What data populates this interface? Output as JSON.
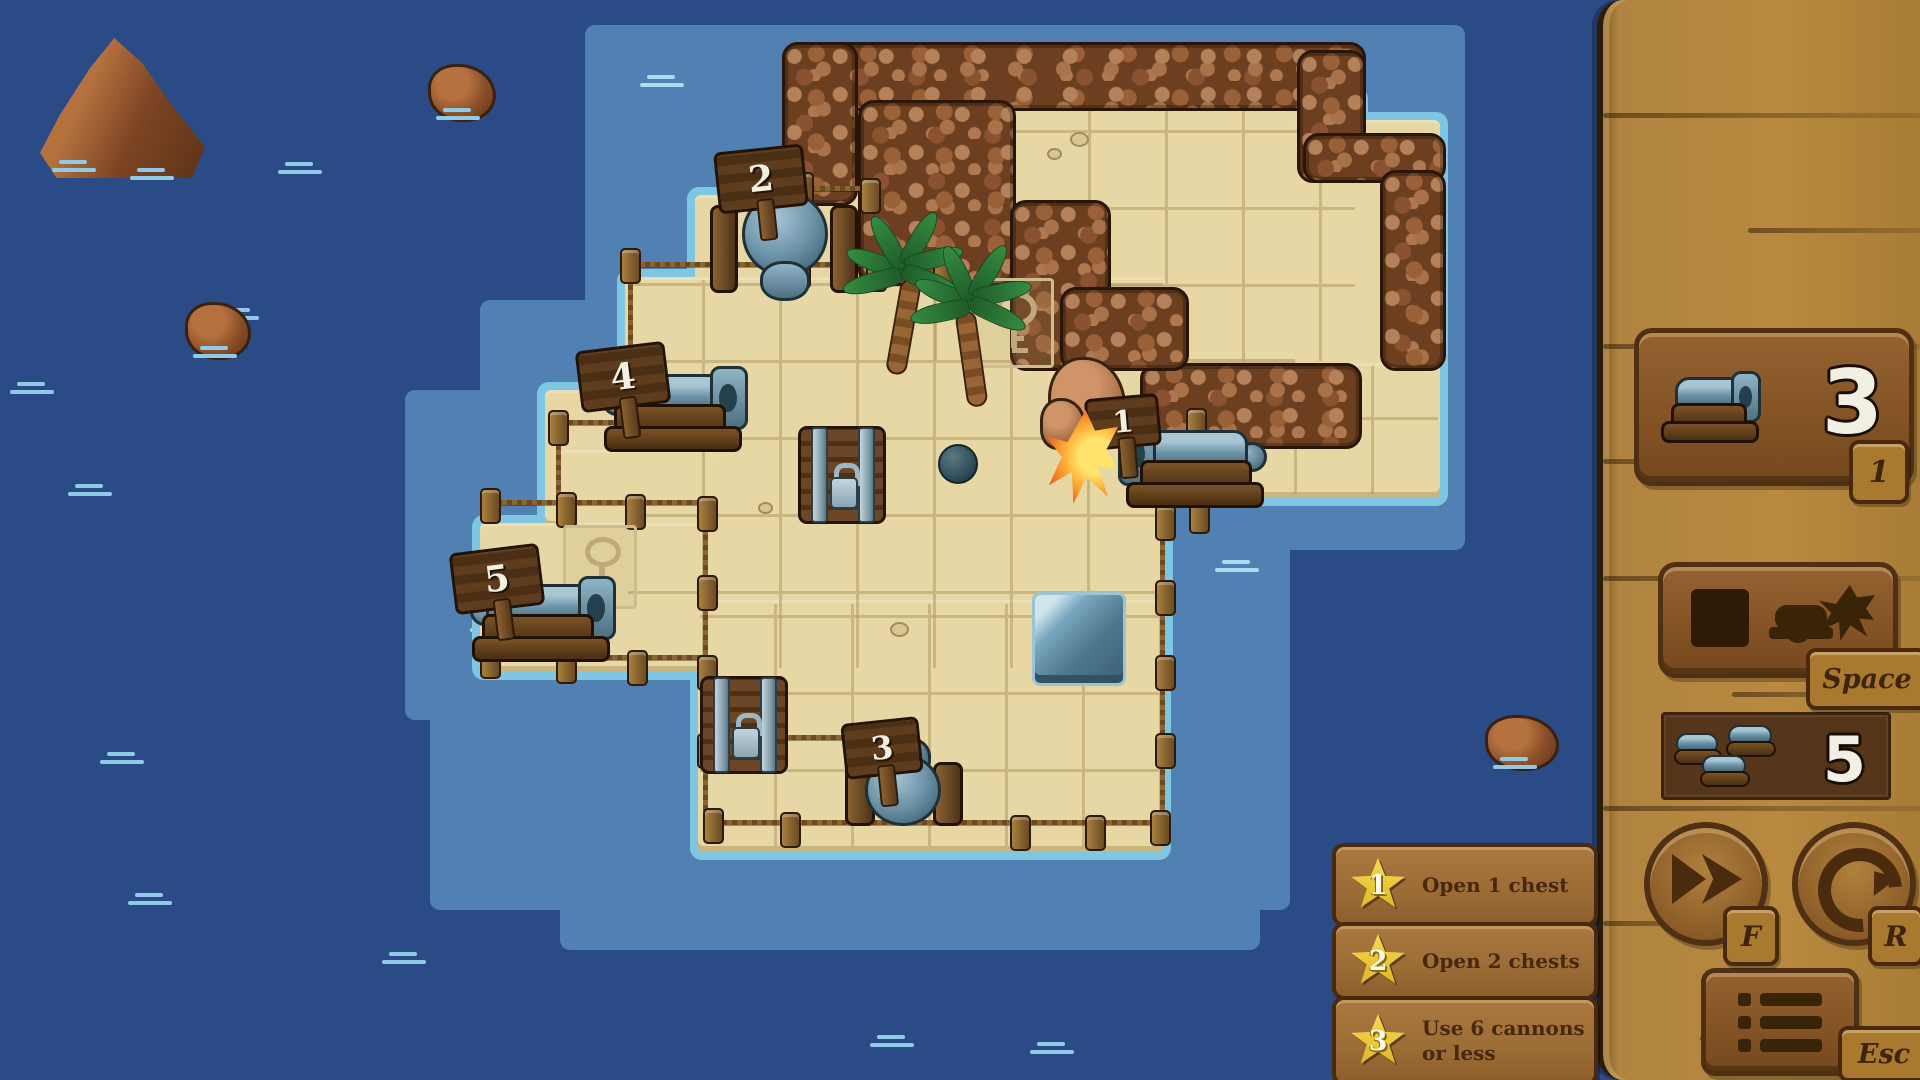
{
  "hud": {
    "cannon_button": {
      "count": "3",
      "hotkey": "1",
      "icon": "cannon-icon"
    },
    "fire_button": {
      "hotkey": "Space",
      "icon": "firing-cannon-icon"
    },
    "cannons_used": {
      "value": "5",
      "icon": "triple-cannon-icon"
    },
    "fast_forward": {
      "hotkey": "F",
      "icon": "fast-forward-icon"
    },
    "restart": {
      "hotkey": "R",
      "icon": "restart-arrow-icon"
    },
    "menu": {
      "hotkey": "Esc",
      "icon": "menu-list-icon"
    }
  },
  "objectives": [
    {
      "star": "1",
      "text": "Open 1 chest"
    },
    {
      "star": "2",
      "text": "Open 2 chests"
    },
    {
      "star": "3",
      "text": "Use 6 cannons or less"
    }
  ],
  "map": {
    "cannons": [
      {
        "label": "1",
        "facing": "west",
        "state": "firing"
      },
      {
        "label": "2",
        "facing": "south",
        "state": "idle"
      },
      {
        "label": "3",
        "facing": "north",
        "state": "idle"
      },
      {
        "label": "4",
        "facing": "east",
        "state": "idle"
      },
      {
        "label": "5",
        "facing": "east",
        "state": "idle"
      }
    ],
    "chests": [
      "closed",
      "closed"
    ],
    "key_marks": 2,
    "cannonball_in_flight": true,
    "palm_trees": 2,
    "water_pit_tiles": 1
  },
  "colors": {
    "deep_water": "#2a4b85",
    "shallow_water": "#5181b3",
    "shore_fringe": "#7fc6e2",
    "sand": "#e7d7a4",
    "rock_brown": "#8a5230",
    "wood_panel": "#b8893f",
    "wood_dark": "#4f3012",
    "steel_blue": "#6d93a8",
    "star_gold": "#eac63a"
  }
}
